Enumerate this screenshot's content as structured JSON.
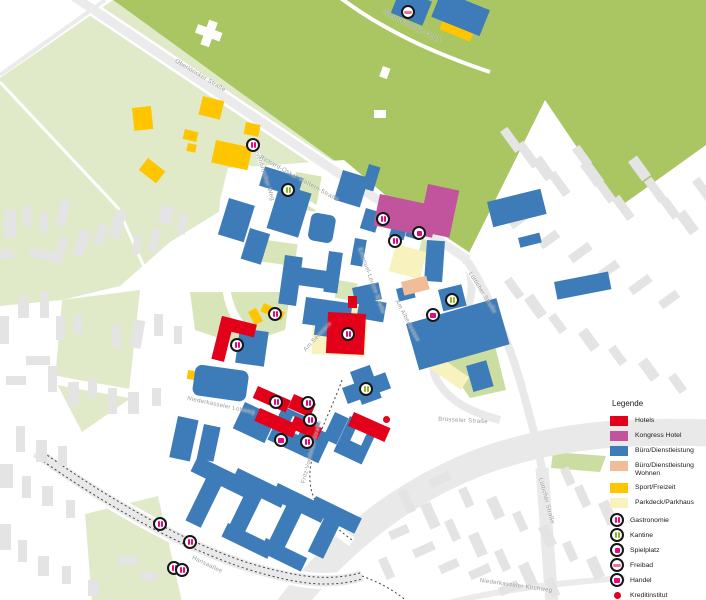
{
  "legend": {
    "title": "Legende",
    "areas": [
      {
        "label": "Hotels",
        "color": "#E3001B"
      },
      {
        "label": "Kongress Hotel",
        "color": "#C2549E"
      },
      {
        "label": "Büro/Dienstleistung",
        "color": "#3E7CB9"
      },
      {
        "label": "Büro/Dienstleistung Wohnen",
        "color": "#F3BC99"
      },
      {
        "label": "Sport/Freizeit",
        "color": "#FFC600"
      },
      {
        "label": "Parkdeck/Parkhaus",
        "color": "#F8F3BE"
      }
    ],
    "points": [
      {
        "label": "Gastronomie",
        "icon": "gastronomie",
        "color": "#E5097F"
      },
      {
        "label": "Kantine",
        "icon": "kantine",
        "color": "#8CB821"
      },
      {
        "label": "Spielplatz",
        "icon": "spielplatz",
        "color": "#E5097F"
      },
      {
        "label": "Freibad",
        "icon": "freibad",
        "color": "#EF6FA8"
      },
      {
        "label": "Handel",
        "icon": "handel",
        "color": "#E5097F"
      },
      {
        "label": "Kreditinstitut",
        "icon": "kreditinstitut",
        "color": "#E3001B"
      }
    ]
  },
  "map": {
    "streets": [
      {
        "name": "Oberlöricker Straße",
        "x": 200,
        "y": 76,
        "rot": 31
      },
      {
        "name": "Niederkasseler Deich",
        "x": 412,
        "y": 27,
        "rot": 27
      },
      {
        "name": "Grevenbroicher Weg",
        "x": 263,
        "y": 172,
        "rot": 72
      },
      {
        "name": "Richard-Oskar-Mattern-Straße",
        "x": 299,
        "y": 179,
        "rot": 29
      },
      {
        "name": "Emanuel-Leutze-Straße",
        "x": 371,
        "y": 281,
        "rot": 70
      },
      {
        "name": "Am Seestern",
        "x": 318,
        "y": 337,
        "rot": -47
      },
      {
        "name": "Am Albertussee",
        "x": 407,
        "y": 321,
        "rot": 62
      },
      {
        "name": "Lütticher Straße",
        "x": 482,
        "y": 293,
        "rot": 58
      },
      {
        "name": "Brüsseler Straße",
        "x": 463,
        "y": 421,
        "rot": 3
      },
      {
        "name": "Niederkasseler Lohweg",
        "x": 221,
        "y": 406,
        "rot": 12
      },
      {
        "name": "Fritz-Vomfelde-Straße",
        "x": 312,
        "y": 452,
        "rot": -75
      },
      {
        "name": "Hansaallee",
        "x": 207,
        "y": 565,
        "rot": 26
      },
      {
        "name": "Lütticher Straße",
        "x": 546,
        "y": 501,
        "rot": 75
      },
      {
        "name": "Niederkasseler Kirchweg",
        "x": 516,
        "y": 586,
        "rot": 8
      }
    ],
    "pois": [
      {
        "type": "freibad",
        "x": 408,
        "y": 12
      },
      {
        "type": "gastronomie",
        "x": 253,
        "y": 145
      },
      {
        "type": "kantine",
        "x": 288,
        "y": 190
      },
      {
        "type": "gastronomie",
        "x": 383,
        "y": 219
      },
      {
        "type": "spielplatz",
        "x": 419,
        "y": 233
      },
      {
        "type": "gastronomie",
        "x": 395,
        "y": 241
      },
      {
        "type": "kantine",
        "x": 452,
        "y": 300
      },
      {
        "type": "handel",
        "x": 433,
        "y": 315
      },
      {
        "type": "gastronomie",
        "x": 275,
        "y": 314
      },
      {
        "type": "kreditinstitut",
        "x": 350,
        "y": 316
      },
      {
        "type": "gastronomie",
        "x": 348,
        "y": 334
      },
      {
        "type": "gastronomie",
        "x": 237,
        "y": 345
      },
      {
        "type": "kantine",
        "x": 366,
        "y": 389
      },
      {
        "type": "gastronomie",
        "x": 276,
        "y": 402
      },
      {
        "type": "gastronomie",
        "x": 308,
        "y": 403
      },
      {
        "type": "kreditinstitut",
        "x": 386,
        "y": 419
      },
      {
        "type": "gastronomie",
        "x": 310,
        "y": 420
      },
      {
        "type": "handel",
        "x": 281,
        "y": 440
      },
      {
        "type": "gastronomie",
        "x": 307,
        "y": 442
      },
      {
        "type": "gastronomie",
        "x": 160,
        "y": 524
      },
      {
        "type": "gastronomie",
        "x": 190,
        "y": 542
      },
      {
        "type": "gastronomie",
        "x": 174,
        "y": 568
      },
      {
        "type": "gastronomie",
        "x": 182,
        "y": 570
      }
    ]
  }
}
